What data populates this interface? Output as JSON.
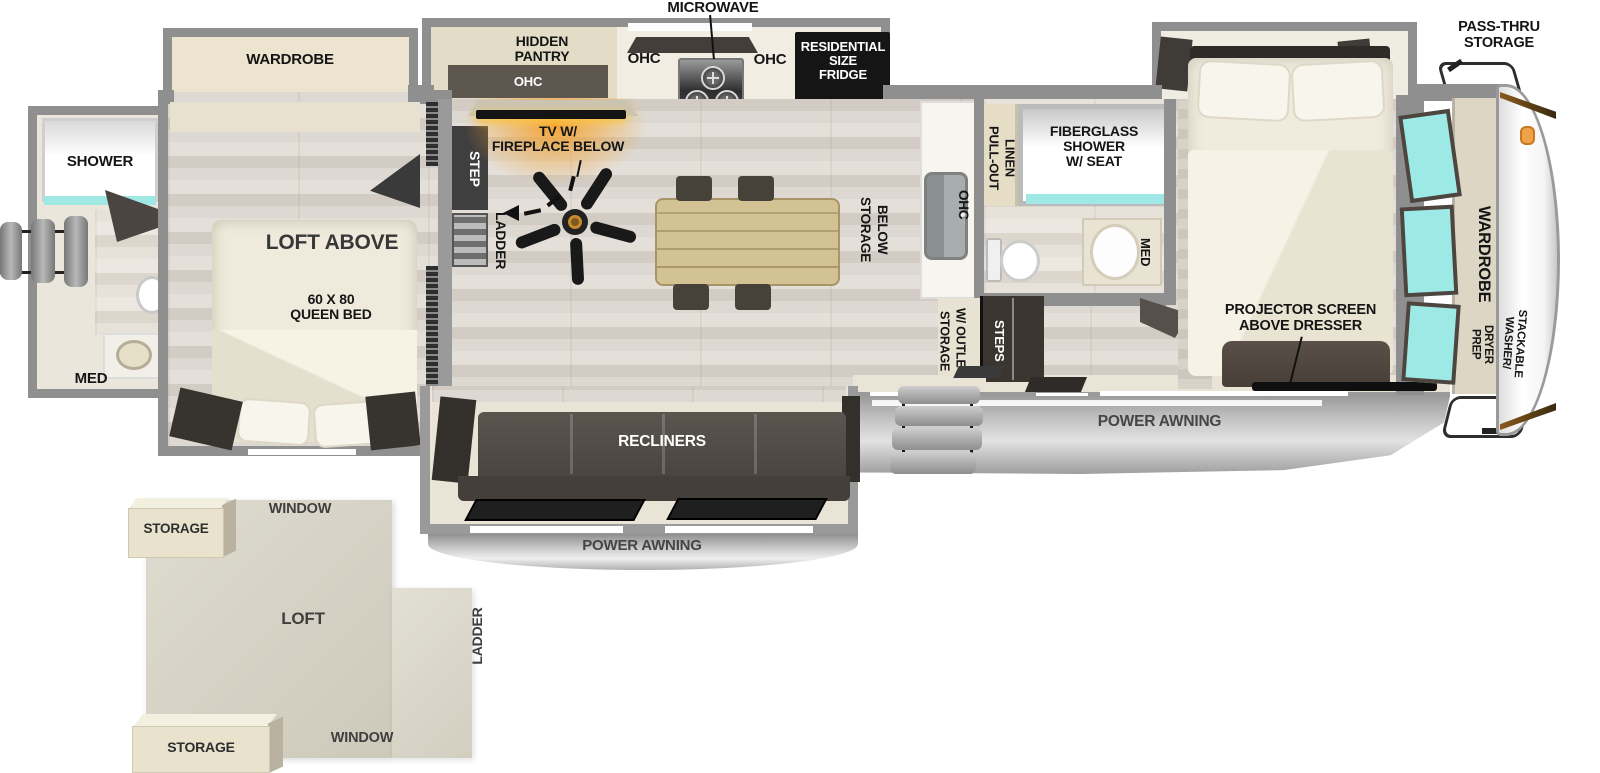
{
  "title": "RV Fifth Wheel Floorplan with Loft",
  "colors": {
    "wall_gray": "#8f8f8f",
    "floor_wood": "#dcd6ce",
    "cabinet_beige": "#e9e2d0",
    "furniture_dark": "#4a443d",
    "appliance_black": "#151515",
    "window_teal": "#9ce9e6",
    "fireplace_glow": "#f4a02a",
    "awning_gray": "#c6c6c6",
    "table_wood": "#cdbb8e",
    "cap_accent": "#7a4a17",
    "loft_beige": "#d8d4c6"
  },
  "kitchen": {
    "microwave": "MICROWAVE",
    "hidden_pantry": "HIDDEN\nPANTRY",
    "ohc_shelf": "OHC",
    "ohc_left": "OHC",
    "ohc_right": "OHC",
    "fridge": "RESIDENTIAL\nSIZE\nFRIDGE",
    "island_ohc": "OHC",
    "storage_below": "STORAGE\nBELOW"
  },
  "living": {
    "tv_fireplace": "TV W/\nFIREPLACE BELOW",
    "recliners": "RECLINERS",
    "step": "STEP",
    "ladder": "LADDER"
  },
  "bathroom": {
    "pull_out_linen": "PULL-OUT\nLINEN",
    "fiberglass_shower": "FIBERGLASS\nSHOWER\nW/ SEAT",
    "med": "MED",
    "storage_w_outlet": "STORAGE\nW/ OUTLET",
    "steps": "STEPS"
  },
  "front_bedroom": {
    "projector": "PROJECTOR SCREEN\nABOVE DRESSER",
    "wardrobe": "WARDROBE"
  },
  "rear_bedroom": {
    "wardrobe": "WARDROBE",
    "loft_above": "LOFT ABOVE",
    "queen_bed": "60 X 80\nQUEEN BED"
  },
  "rear_bath": {
    "shower": "SHOWER",
    "med": "MED"
  },
  "exterior": {
    "pass_thru_storage": "PASS-THRU\nSTORAGE",
    "power_awning_door_side": "POWER AWNING",
    "power_awning_rear": "POWER AWNING",
    "washer_line1": "STACKABLE WASHER/",
    "washer_line2": "DRYER PREP"
  },
  "loft_inset": {
    "storage_top": "STORAGE",
    "storage_bottom": "STORAGE",
    "window_top": "WINDOW",
    "window_bottom": "WINDOW",
    "loft": "LOFT",
    "ladder": "LADDER"
  }
}
